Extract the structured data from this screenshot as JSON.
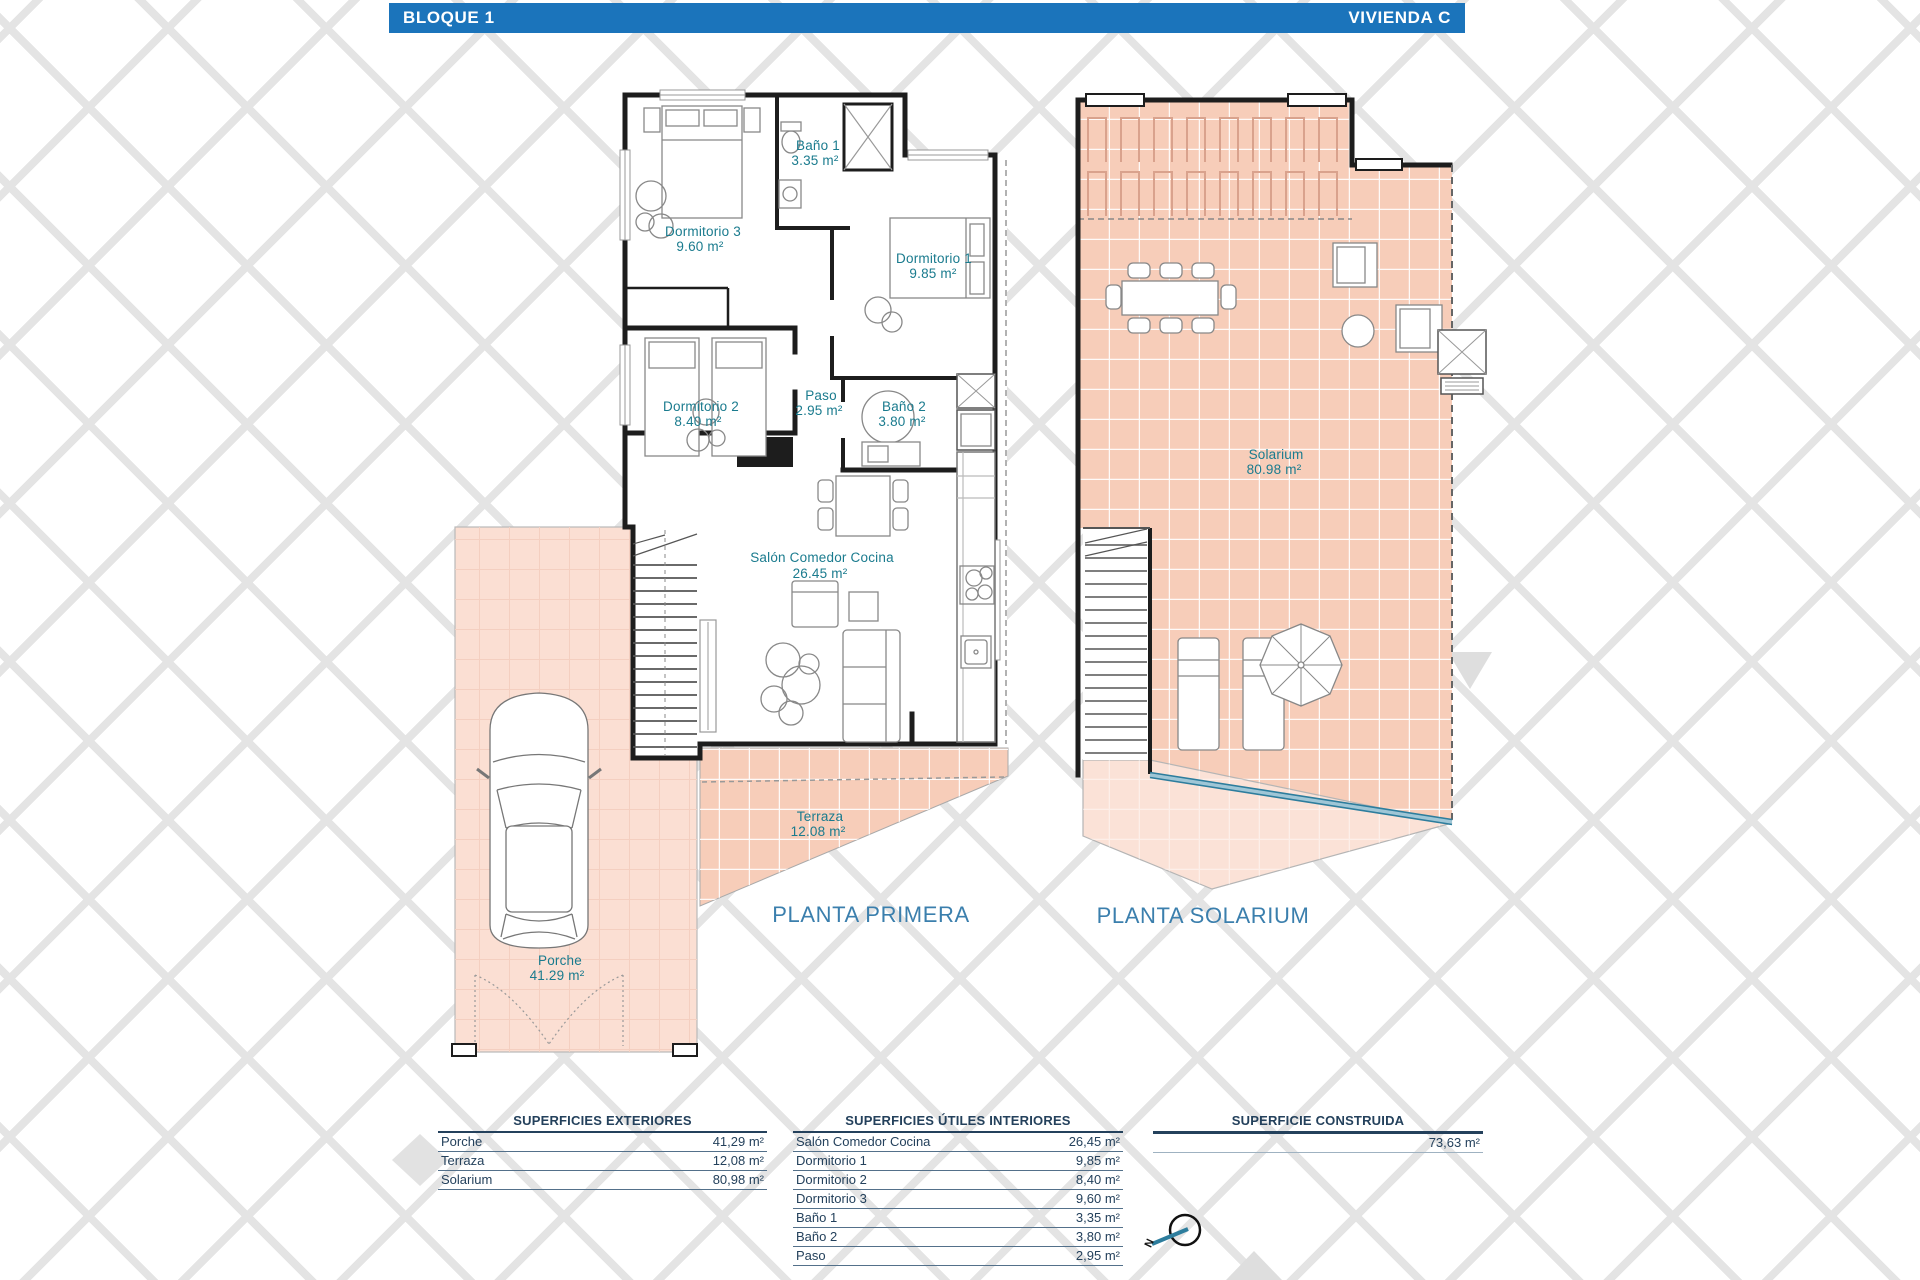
{
  "header": {
    "block_label": "BLOQUE 1",
    "unit_label": "VIVIENDA C"
  },
  "plans": {
    "primera": {
      "title": "PLANTA PRIMERA",
      "rooms": [
        {
          "name": "Baño 1",
          "area": "3.35 m²"
        },
        {
          "name": "Dormitorio 3",
          "area": "9.60 m²"
        },
        {
          "name": "Dormitorio 1",
          "area": "9.85 m²"
        },
        {
          "name": "Dormitorio 2",
          "area": "8.40 m²"
        },
        {
          "name": "Paso",
          "area": "2.95 m²"
        },
        {
          "name": "Baño 2",
          "area": "3.80 m²"
        },
        {
          "name": "Salón Comedor Cocina",
          "area": "26.45 m²"
        },
        {
          "name": "Terraza",
          "area": "12.08 m²"
        },
        {
          "name": "Porche",
          "area": "41.29 m²"
        }
      ]
    },
    "solarium": {
      "title": "PLANTA SOLARIUM",
      "rooms": [
        {
          "name": "Solarium",
          "area": "80.98 m²"
        }
      ]
    }
  },
  "compass": {
    "north_label": "N"
  },
  "tables": {
    "exteriores": {
      "title": "SUPERFICIES EXTERIORES",
      "rows": [
        {
          "label": "Porche",
          "value": "41,29 m²"
        },
        {
          "label": "Terraza",
          "value": "12,08 m²"
        },
        {
          "label": "Solarium",
          "value": "80,98 m²"
        }
      ]
    },
    "interiores": {
      "title": "SUPERFICIES ÚTILES INTERIORES",
      "rows": [
        {
          "label": "Salón Comedor Cocina",
          "value": "26,45 m²"
        },
        {
          "label": "Dormitorio 1",
          "value": "9,85 m²"
        },
        {
          "label": "Dormitorio 2",
          "value": "8,40 m²"
        },
        {
          "label": "Dormitorio 3",
          "value": "9,60 m²"
        },
        {
          "label": "Baño 1",
          "value": "3,35 m²"
        },
        {
          "label": "Baño 2",
          "value": "3,80 m²"
        },
        {
          "label": "Paso",
          "value": "2,95 m²"
        }
      ]
    },
    "construida": {
      "title": "SUPERFICIE CONSTRUIDA",
      "rows": [
        {
          "label": "",
          "value": "73,63 m²"
        }
      ]
    }
  },
  "colors": {
    "header_bg": "#1b74bb",
    "room_label": "#1a7b8e",
    "plan_title": "#3b7fad",
    "table_text": "#24415c",
    "tile_fill": "#f7cdb9",
    "tile_fill_light": "#fbdfd3",
    "wall": "#1d1d1d",
    "railing": "#2d7d9d"
  }
}
